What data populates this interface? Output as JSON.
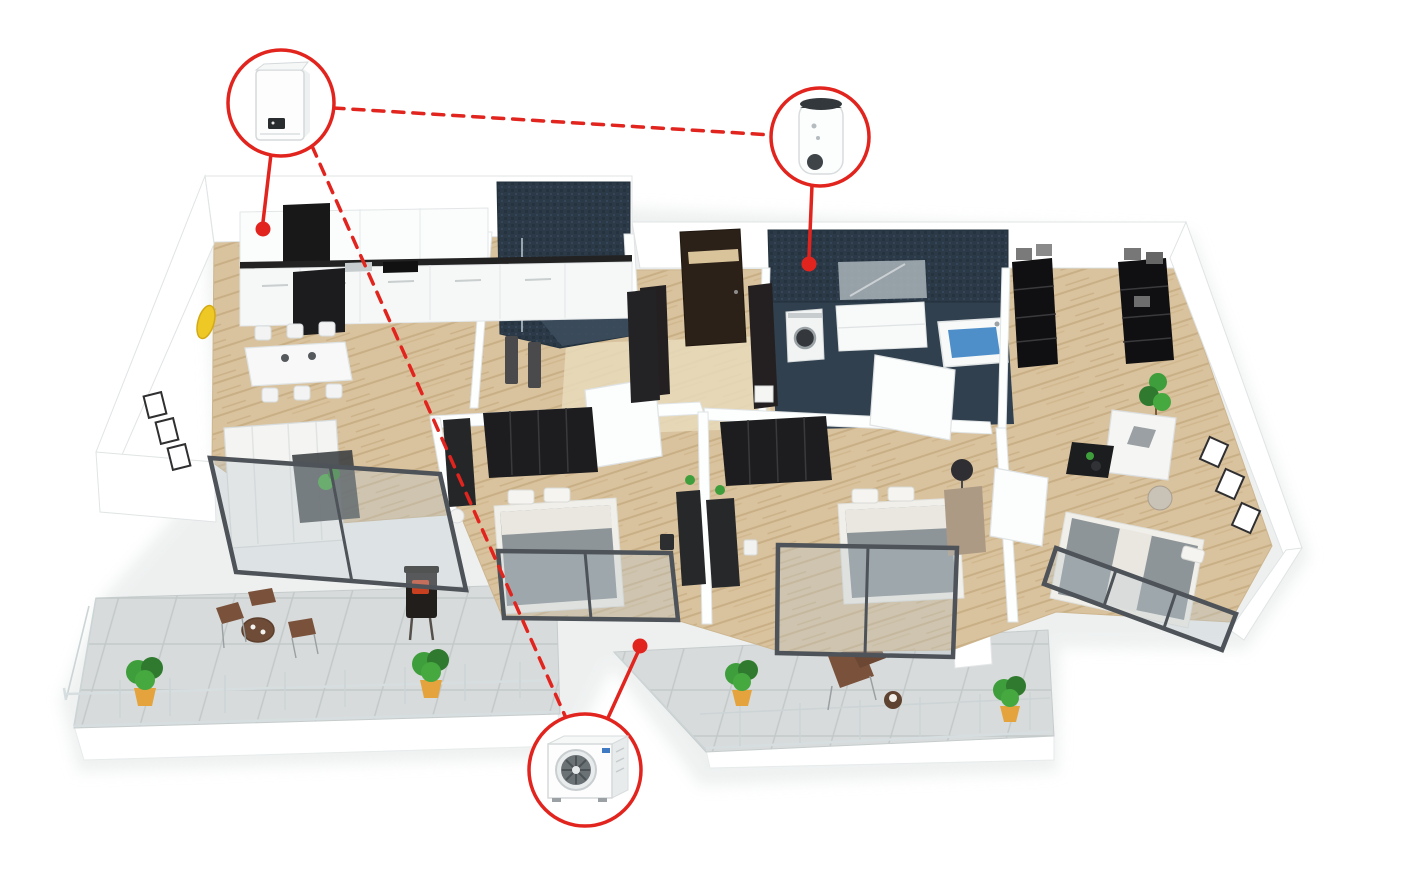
{
  "scene": {
    "label": "3D isometric apartment floor plan with heat pump system callouts"
  },
  "colors": {
    "accent_red": "#e2241e",
    "wood_floor": "#d9c29e",
    "wood_floor_light": "#e8dabb",
    "navy_tile": "#2c3a48",
    "navy_floor": "#3c4c5c",
    "terrace_tile": "#d8dbdb",
    "wall_white": "#ffffff",
    "dark_furniture": "#1e1e20",
    "glass_frame": "#4d5358",
    "plant_green": "#3f9e3c",
    "pot_orange": "#e5a33d",
    "water_blue": "#3f86c4",
    "warning_yellow": "#eec824",
    "logo_blue": "#3f7ac2"
  },
  "callouts": {
    "indoor_unit": {
      "icon": "wall-mounted-boiler-icon",
      "label": "wall-mounted heat pump indoor unit"
    },
    "water_tank": {
      "icon": "hot-water-cylinder-icon",
      "label": "domestic hot water cylinder"
    },
    "outdoor_unit": {
      "icon": "outdoor-heat-pump-icon",
      "label": "heat pump outdoor unit"
    }
  }
}
